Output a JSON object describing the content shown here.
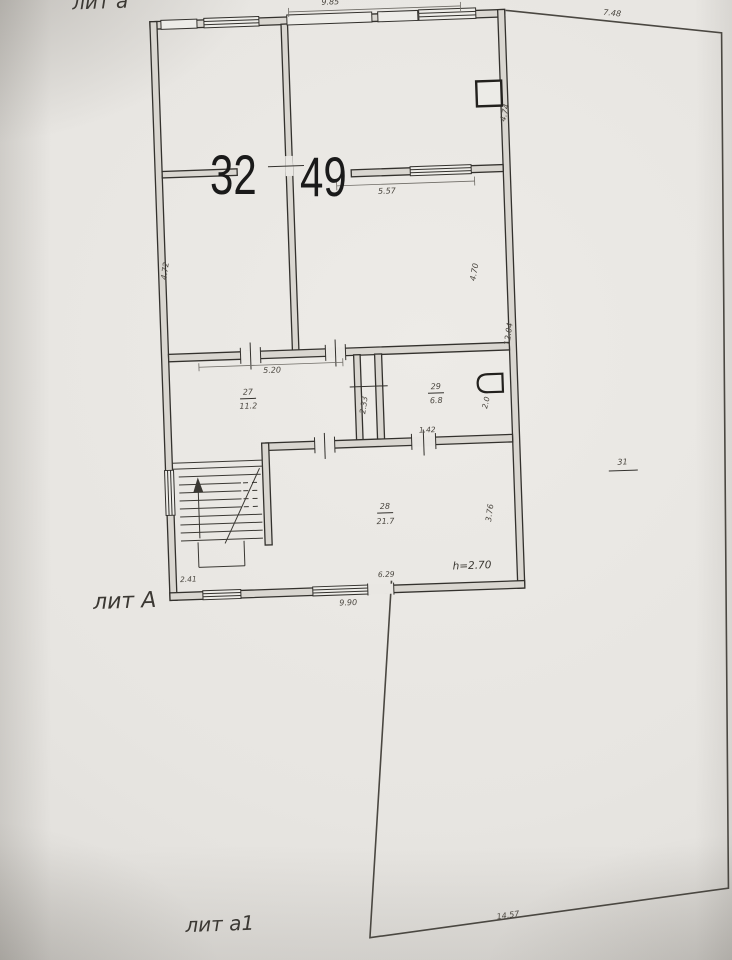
{
  "plan": {
    "overlay_numbers": {
      "left": "32",
      "right": "49"
    },
    "structure_labels": {
      "top": "лит а",
      "main": "лит А",
      "annex": "лит а1"
    },
    "rooms": {
      "r27": {
        "number": "27",
        "area": "11.2"
      },
      "r28": {
        "number": "28",
        "area": "21.7"
      },
      "r29": {
        "number": "29",
        "area": "6.8"
      }
    },
    "dims": {
      "d985": "9.85",
      "d748": "7.48",
      "d474": "4.74",
      "d557": "5.57",
      "d472": "4.72",
      "d470": "4.70",
      "d1204": "12.04",
      "d520": "5.20",
      "d233": "2.33",
      "d20": "2.0",
      "d142": "1.42",
      "d241": "2.41",
      "d629": "6.29",
      "d376": "3.76",
      "d990": "9.90",
      "d1457": "14.57"
    },
    "notes": {
      "plot_number": "31",
      "ceiling_height": "h=2.70"
    }
  }
}
